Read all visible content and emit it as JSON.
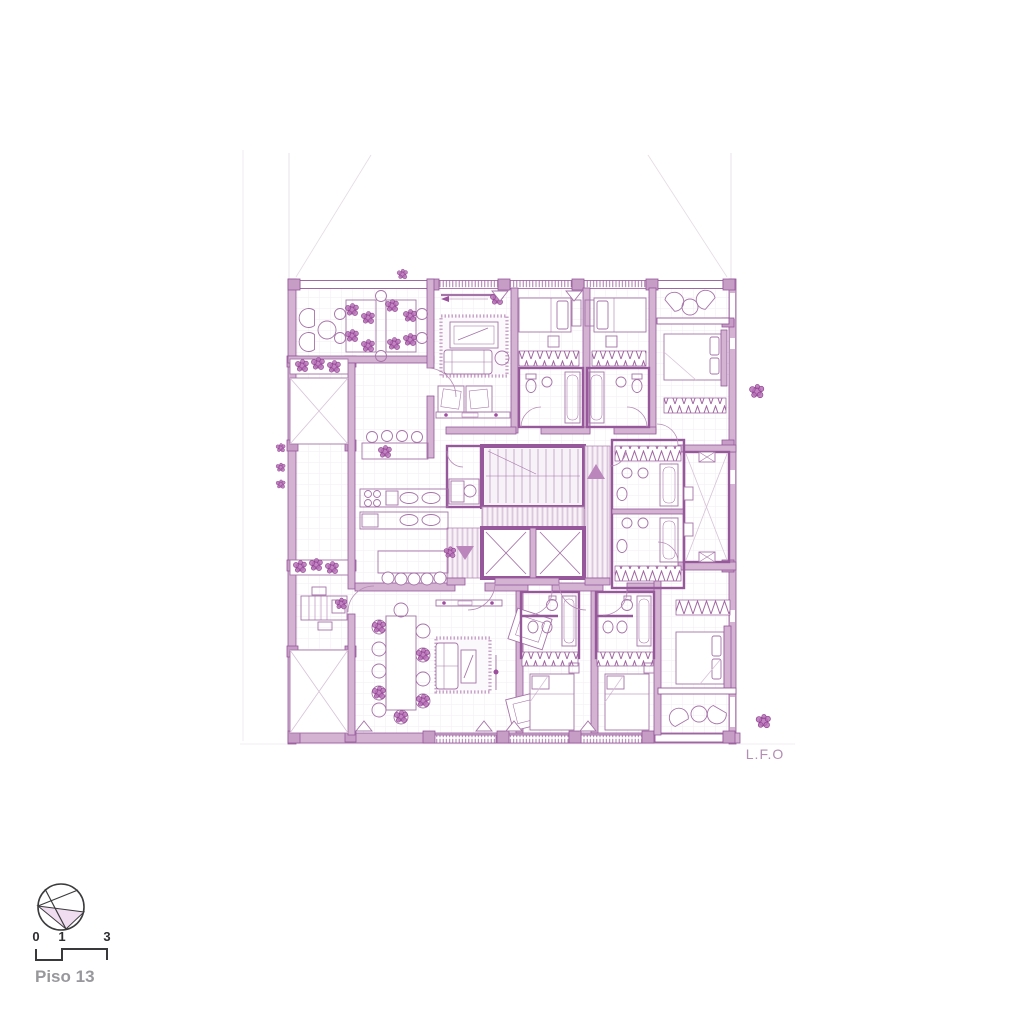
{
  "canvas": {
    "background": "#ffffff",
    "width": 1024,
    "height": 1024
  },
  "drawing": {
    "type": "architectural-floor-plan",
    "author_initials": "L.F.O",
    "colors": {
      "wall_fill": "#d3b2d2",
      "wall_stroke": "#96589a",
      "furniture_line": "#a673a8",
      "column_fill": "#c69dc5",
      "hatch_stripe": "#ddc7dd",
      "grid_line": "#f2ecf3",
      "projection_line": "#e4dce4",
      "accent_dark": "#8d3f8d"
    }
  },
  "footer": {
    "floor_label": "Piso 13",
    "floor_label_color": "#98989c",
    "compass_icon": "north-arrow-icon",
    "scale_bar": {
      "tick_labels": [
        "0",
        "1",
        "3"
      ],
      "units": ""
    }
  }
}
